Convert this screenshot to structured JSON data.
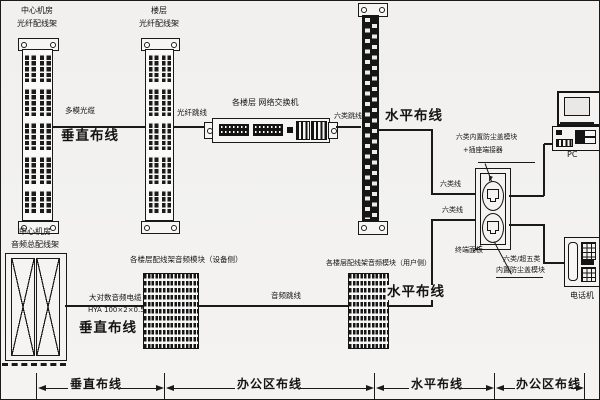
{
  "colors": {
    "background": "#f2f1ef",
    "line": "#1a1a1a"
  },
  "fiber_section": {
    "rack_central": {
      "title_line1": "中心机房",
      "title_line2": "光纤配线架"
    },
    "rack_floor": {
      "title_line1": "楼层",
      "title_line2": "光纤配线架"
    },
    "multimode_cable_label": "多模光缆",
    "vertical_cabling_label": "垂直布线",
    "fiber_patch_label": "光纤跳线",
    "switch_label": "各楼层 网络交换机",
    "cat6_patch_label": "六类跳线",
    "horizontal_cabling_label": "水平布线",
    "cat6_cable_upper_label": "六类线",
    "cat6_cable_lower_label": "六类线"
  },
  "workarea_section": {
    "jack_module_label_line1": "六类内置防尘盖模块",
    "jack_module_label_line2": "+插座端接器",
    "pc_label": "PC",
    "terminal_panel_label": "终端面板",
    "lower_module_label_line1": "六类/超五类",
    "lower_module_label_line2": "内置防尘盖模块",
    "telephone_label": "电话机"
  },
  "audio_section": {
    "mdf_title_line1": "中心机房",
    "mdf_title_line2": "音频总配线架",
    "equipment_block_label": "各楼层配线架音频模块（设备侧）",
    "user_block_label": "各楼层配线架音频模块（用户侧）",
    "multipair_cable_label": "大对数音频电缆",
    "cable_spec_label": "HYA 100×2×0.5",
    "vertical_cabling_label": "垂直布线",
    "audio_patch_label": "音频跳线",
    "horizontal_cabling_label": "水平布线"
  },
  "dimension_bar": {
    "segment1_label": "垂直布线",
    "segment2_label": "办公区布线",
    "segment3_label": "水平布线",
    "segment4_label": "办公区布线"
  }
}
